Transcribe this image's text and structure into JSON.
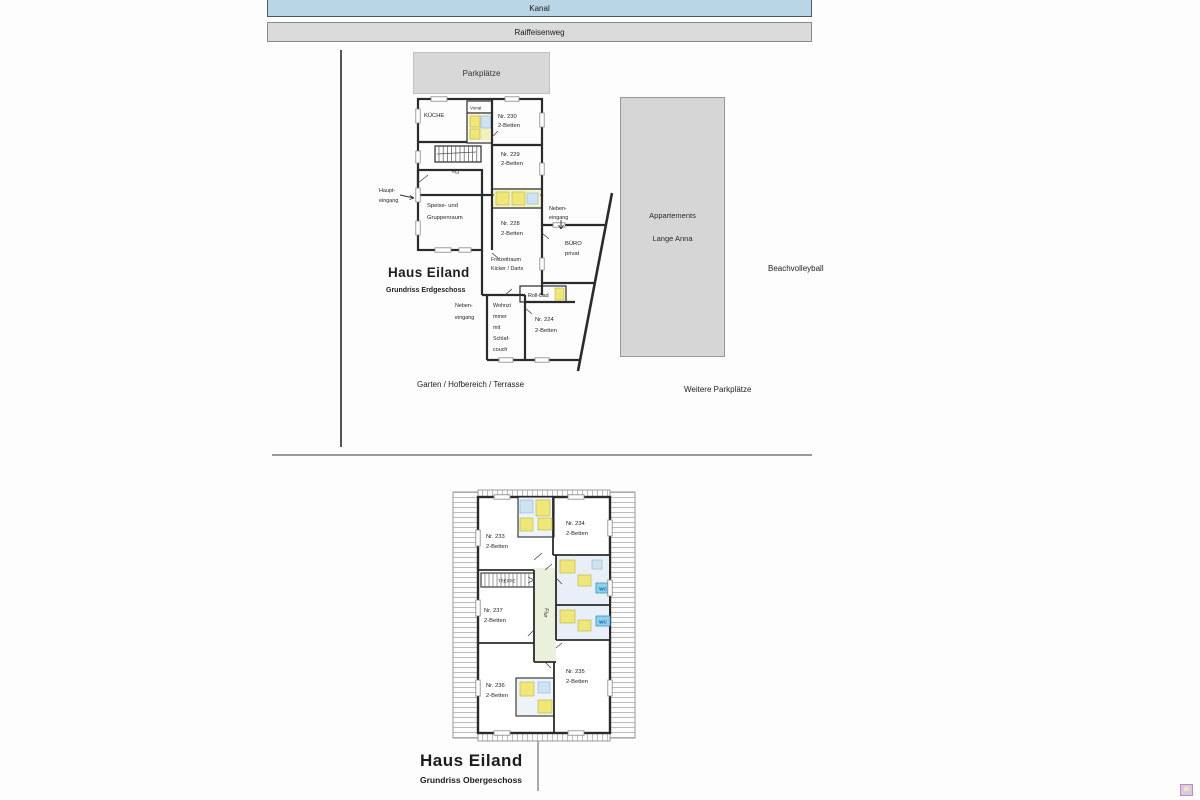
{
  "streets": {
    "kanal": "Kanal",
    "raiffeisenweg": "Raiffeisenweg"
  },
  "site": {
    "parkplaetze": "Parkplätze",
    "appartements_line1": "Appartements",
    "appartements_line2": "Lange Anna",
    "beachvolleyball": "Beachvolleyball",
    "garten": "Garten / Hofbereich / Terrasse",
    "weitere_parkplaetze": "Weitere Parkplätze"
  },
  "ground_floor": {
    "title": "Haus Eiland",
    "subtitle": "Grundriss Erdgeschoss",
    "rooms": [
      {
        "l1": "Nr. 230",
        "l2": "2-Betten"
      },
      {
        "l1": "Nr. 229",
        "l2": "2-Betten"
      },
      {
        "l1": "Nr. 228",
        "l2": "2-Betten"
      },
      {
        "l1": "Nr. 224",
        "l2": "2-Betten"
      }
    ],
    "labels": {
      "kueche": "KÜCHE",
      "vorrat": "Vorrat",
      "flur": "Flur",
      "haupteingang": {
        "l1": "Haupt-",
        "l2": "eingang"
      },
      "speise": {
        "l1": "Speise- und",
        "l2": "Gruppenraum"
      },
      "nebeneingang_rechts": {
        "l1": "Neben-",
        "l2": "eingang"
      },
      "buero": {
        "l1": "BÜRO",
        "l2": "privat"
      },
      "freizeit": {
        "l1": "Freizeitraum",
        "l2": "Kicker / Darts"
      },
      "rollbad": "Roll-Bad",
      "nebeneingang_unten": {
        "l1": "Neben-",
        "l2": "eingang"
      },
      "wohnzimmer": {
        "l1": "Wohnzi",
        "l2": "mmer",
        "l3": "mit",
        "l4": "Schlaf-",
        "l5": "couch"
      }
    }
  },
  "upper_floor": {
    "title": "Haus Eiland",
    "subtitle": "Grundriss Obergeschoss",
    "rooms": [
      {
        "l1": "Nr. 233",
        "l2": "2-Betten"
      },
      {
        "l1": "Nr. 234",
        "l2": "2-Betten"
      },
      {
        "l1": "Nr. 237",
        "l2": "2-Betten"
      },
      {
        "l1": "Nr. 236",
        "l2": "2-Betten"
      },
      {
        "l1": "Nr. 235",
        "l2": "2-Betten"
      }
    ],
    "labels": {
      "treppe": "TREPPE",
      "flur": "Flur",
      "wc": "WC"
    }
  },
  "colors": {
    "kanal_fill": "#b9d6e6",
    "street_fill": "#dbdbdb",
    "area_fill": "#d8d8d8",
    "wall": "#2b2b2b",
    "bath_yellow": "#efe77a",
    "bath_blue": "#cfe2f2",
    "corridor_green": "#e9f0dc",
    "wc_fill": "#8ed0ec",
    "wc_text": "#1258a8"
  }
}
